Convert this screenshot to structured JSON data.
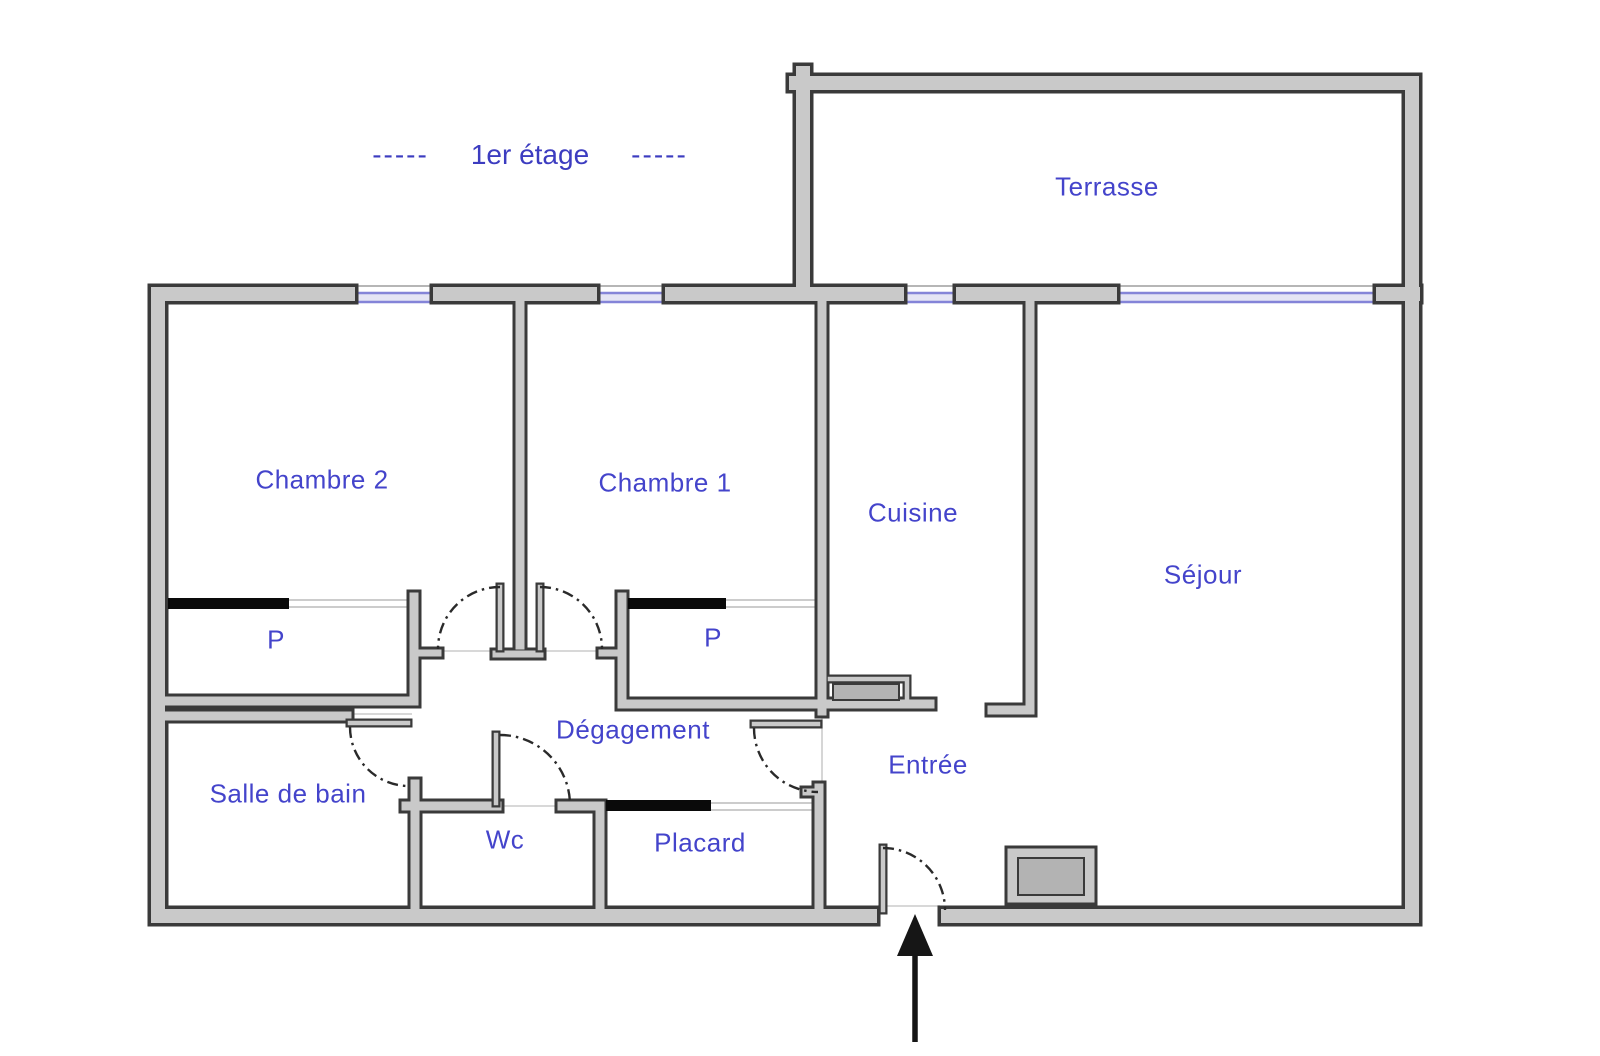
{
  "title": {
    "dashes_left": "-----",
    "text": "1er étage",
    "dashes_right": "-----"
  },
  "rooms": {
    "terrasse": {
      "label": "Terrasse"
    },
    "chambre2": {
      "label": "Chambre 2"
    },
    "chambre1": {
      "label": "Chambre 1"
    },
    "cuisine": {
      "label": "Cuisine"
    },
    "sejour": {
      "label": "Séjour"
    },
    "placard_chambre2": {
      "label": "P"
    },
    "placard_chambre1": {
      "label": "P"
    },
    "degagement": {
      "label": "Dégagement"
    },
    "salle_de_bain": {
      "label": "Salle de bain"
    },
    "wc": {
      "label": "Wc"
    },
    "placard": {
      "label": "Placard"
    },
    "entree": {
      "label": "Entrée"
    }
  },
  "icons": {
    "entrance_arrow": "up-arrow"
  },
  "colors": {
    "background": "#ffffff",
    "wall_fill": "#c9c9c9",
    "wall_outline": "#3a3a3a",
    "window_color": "#8484d8",
    "label_text": "#4444cb",
    "title_text": "#3c3cc0",
    "door_arc": "#2a2a2a",
    "sliding_door": "#0a0a0a",
    "duct_fill": "#b3b3b3"
  }
}
